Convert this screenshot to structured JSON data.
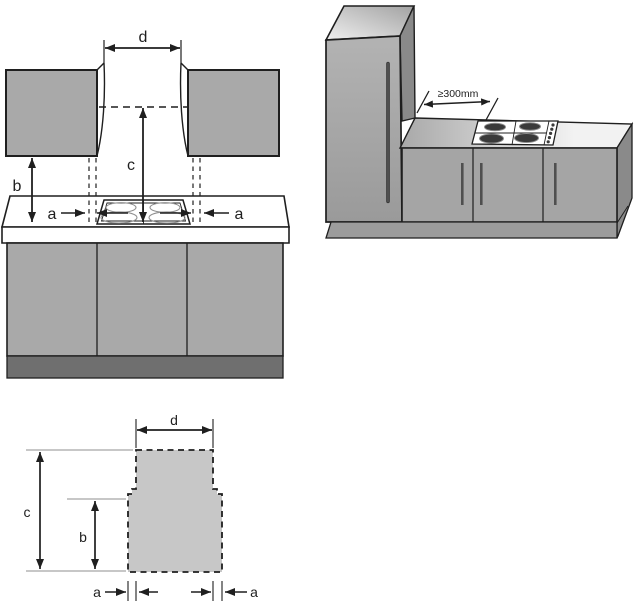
{
  "colors": {
    "line": "#1f1f1f",
    "white": "#ffffff",
    "cabinet_gray": "#a9a9a9",
    "plinth_dark": "#6f6f6f",
    "front_gray": "#a5a5a5",
    "side_gray": "#8a8a8a",
    "plinth_3d": "#9c9c9c",
    "handle_dark": "#4f4f4f",
    "burner_dark": "#3a3a3a",
    "burner_rim": "#8d8d8d",
    "hob_ring_gray": "#909090",
    "cutout_fill": "#c7c7c7",
    "ext_line_gray": "#8f8f8f",
    "top_face_light": "#f0f0f0",
    "top_face_dark": "#a2a2a2",
    "counter_left": "#a8a8a8",
    "counter_right": "#f2f2f2",
    "door_light": "#b3b3b3",
    "door_dark": "#9a9a9a"
  },
  "front_view": {
    "dim_d": "d",
    "dim_c": "c",
    "dim_b": "b",
    "dim_a_left": "a",
    "dim_a_right": "a"
  },
  "iso_view": {
    "clearance": "≥300mm"
  },
  "cutout_view": {
    "dim_d": "d",
    "dim_c": "c",
    "dim_b": "b",
    "dim_a_left": "a",
    "dim_a_right": "a"
  }
}
